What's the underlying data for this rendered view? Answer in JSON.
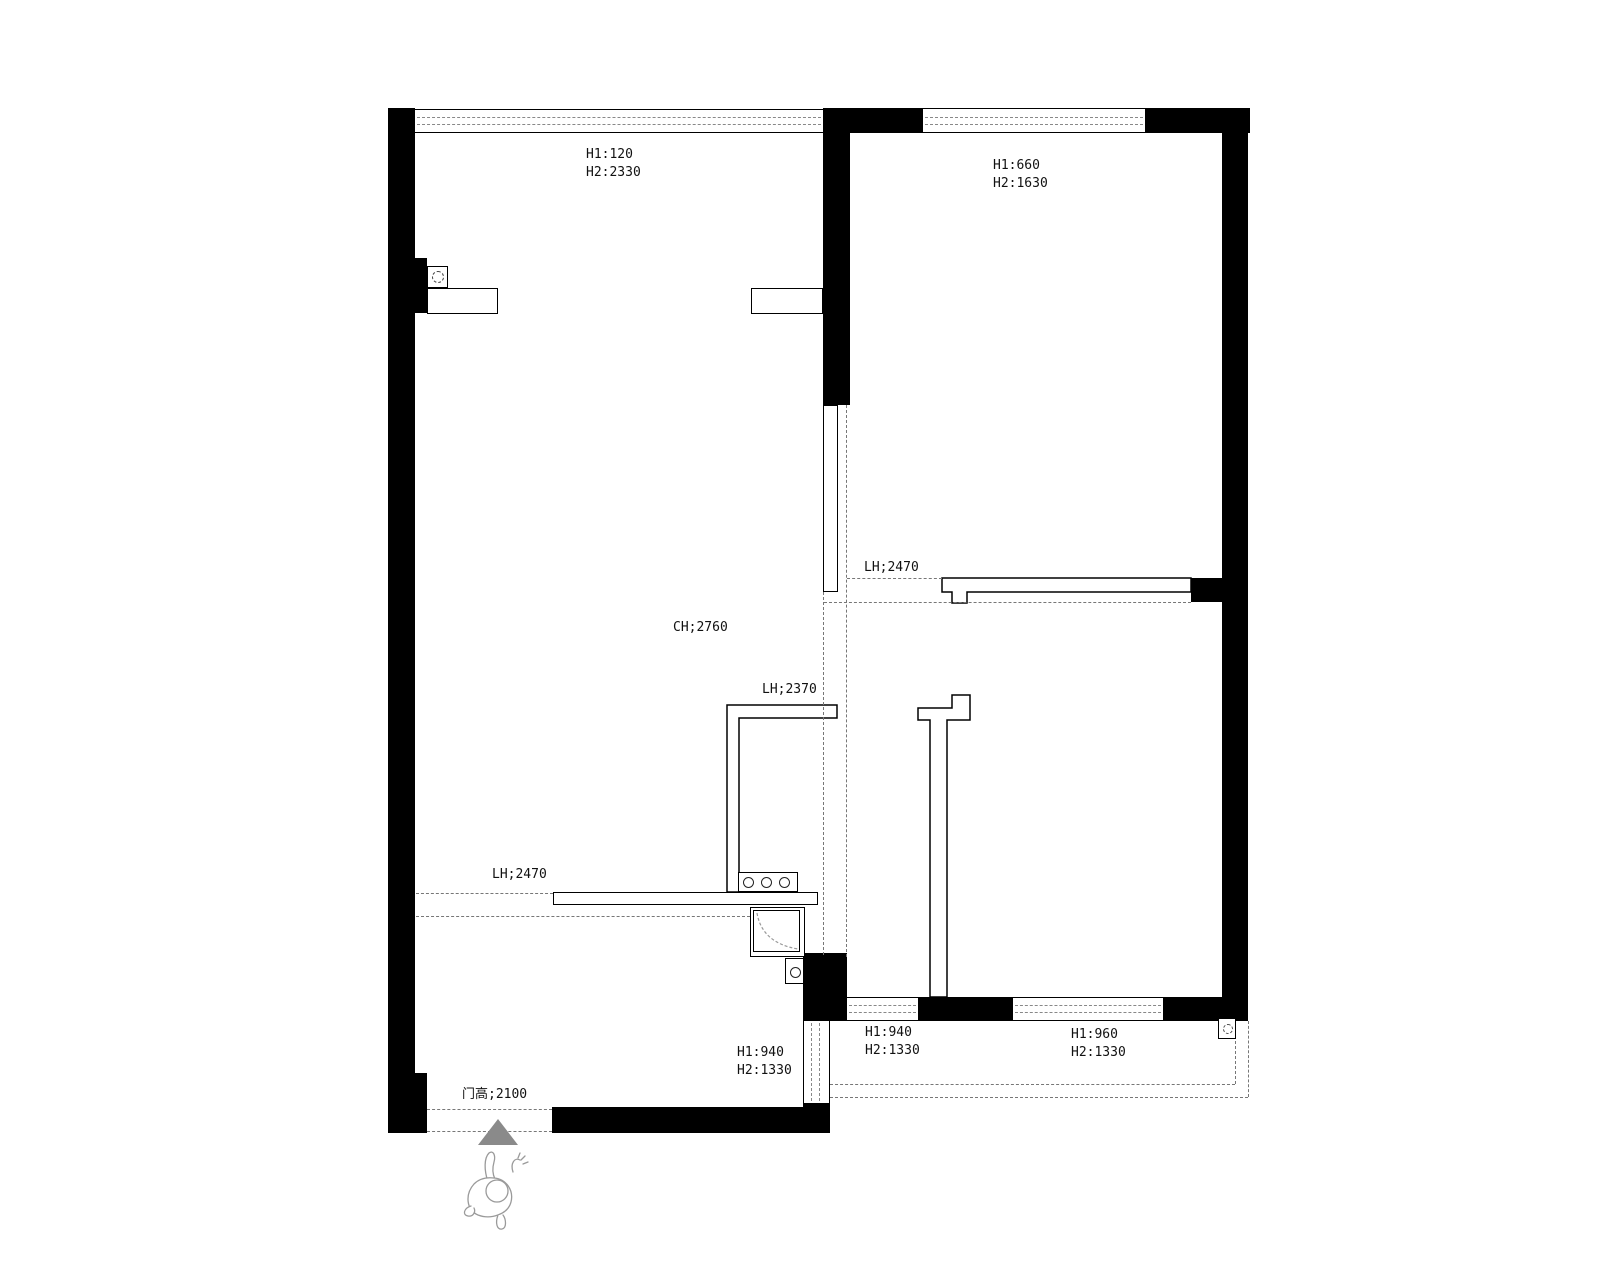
{
  "title": "apartment-floor-plan",
  "colors": {
    "wall": "#000000",
    "dash_line": "#777777",
    "glazing_dash": "#888888",
    "entry_arrow": "#8a8a8a",
    "figure": "#9a9a9a"
  },
  "annotations": {
    "top_left_window": {
      "line1": "H1:120",
      "line2": "H2:2330"
    },
    "top_right_window": {
      "line1": "H1:660",
      "line2": "H2:1630"
    },
    "ceiling_height": "CH;2760",
    "passage_mid": "LH;2370",
    "passage_upper": "LH;2470",
    "passage_kitchen": "LH;2470",
    "entry_door": "门高;2100",
    "bottom_window_left": {
      "line1": "H1:940",
      "line2": "H2:1330"
    },
    "bottom_window_mid": {
      "line1": "H1:940",
      "line2": "H2:1330"
    },
    "bottom_window_right": {
      "line1": "H1:960",
      "line2": "H2:1330"
    }
  }
}
